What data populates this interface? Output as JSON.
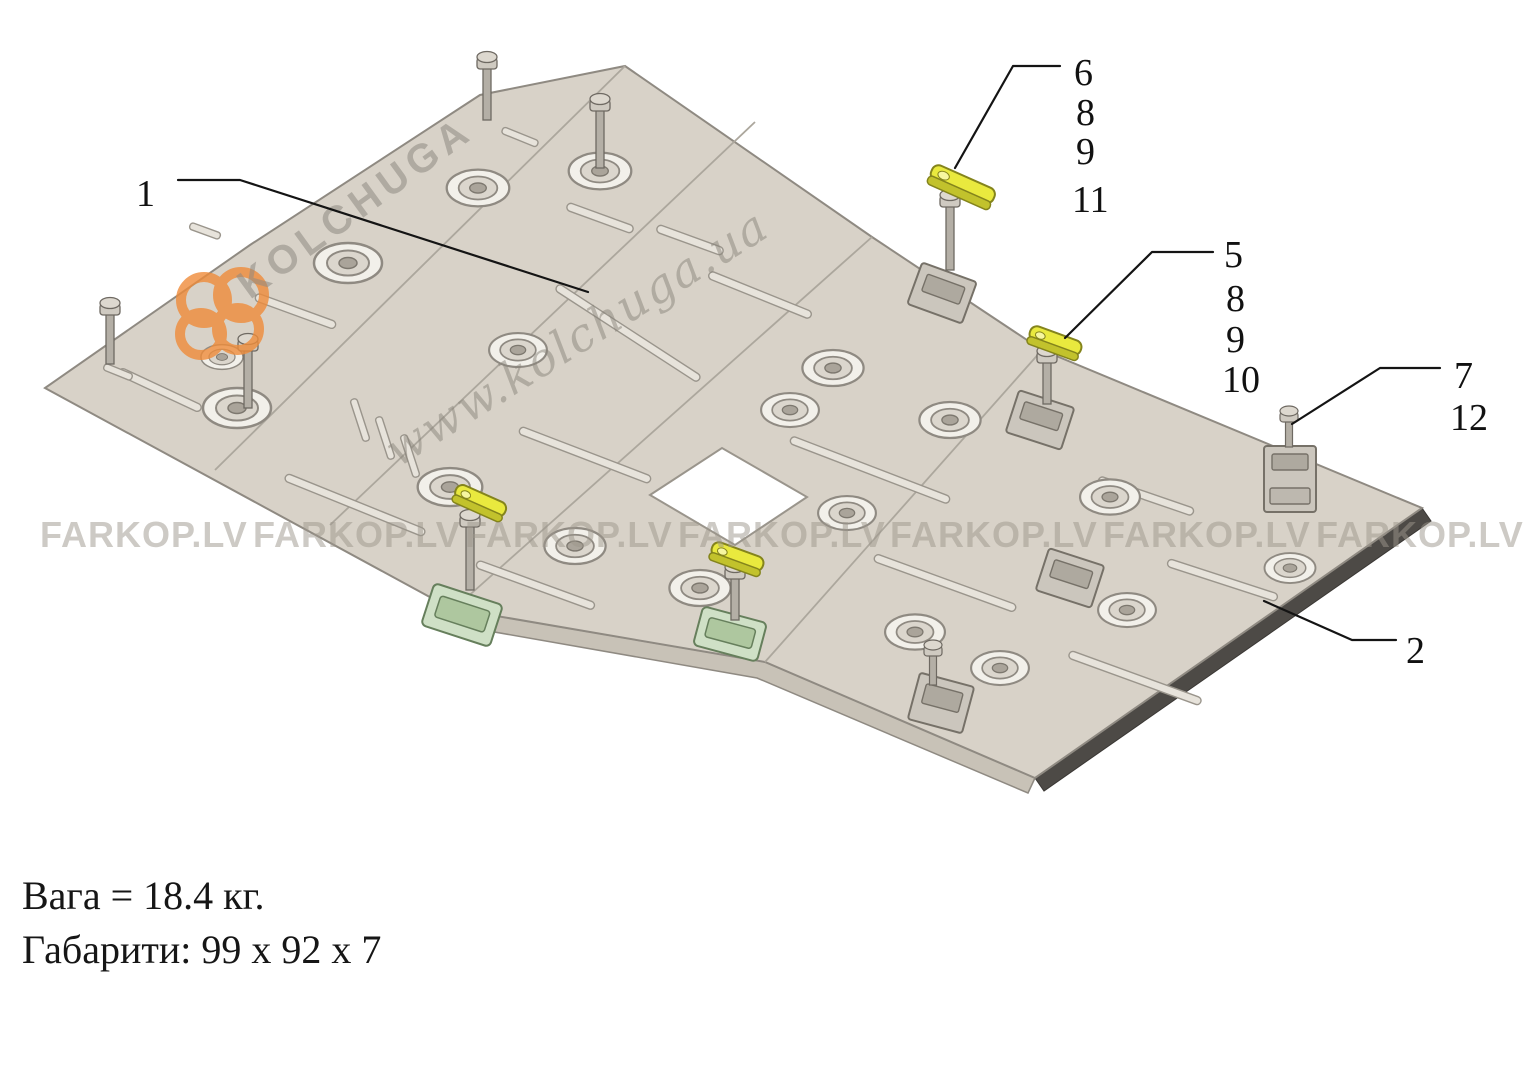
{
  "watermarks": {
    "brand": "KOLCHUGA",
    "site": "www.kolchuga.ua",
    "dealer": "FARKOP.LV"
  },
  "callouts": {
    "main_plate": "1",
    "side_plate": "2",
    "fastener_group_a": [
      "6",
      "8",
      "9",
      "11"
    ],
    "fastener_group_b": [
      "5",
      "8",
      "9",
      "10"
    ],
    "fastener_group_c": [
      "7",
      "12"
    ]
  },
  "specs": {
    "weight": "Вага = 18.4 кг.",
    "dimensions": "Габарити: 99 х 92 х 7"
  },
  "colors": {
    "plate": "#d8d2c8",
    "plate_fold": "#c8c2b7",
    "edge_dark": "#4d4a46",
    "bracket_yellow": "#e9e93e",
    "bracket_green": "#cfe0c6",
    "logo_orange": "#ef8c3a",
    "text": "#111111"
  }
}
